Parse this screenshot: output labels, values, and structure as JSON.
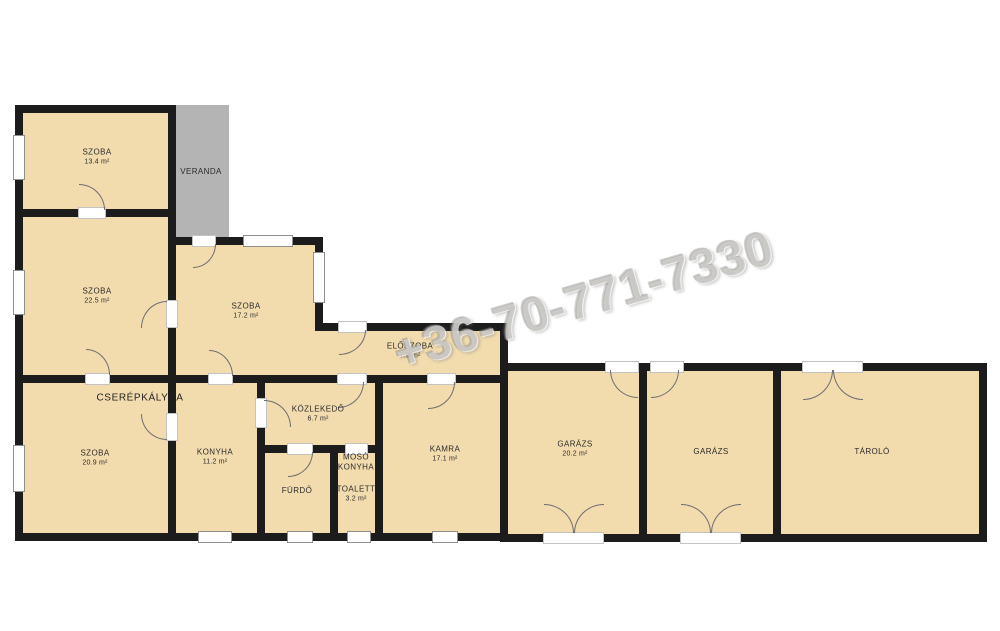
{
  "title": "Floor plan",
  "watermark": {
    "text": "+36-70-771-7330"
  },
  "fixtures": {
    "cserepkalyha_label": "CSERÉPKÁLYHA"
  },
  "colors": {
    "room_fill": "#f2dcae",
    "wall": "#1c1c1c",
    "veranda_fill": "#b4b4b4",
    "background": "#ffffff",
    "watermark_gray": "#b0ada8"
  },
  "rooms": [
    {
      "id": "szoba-13",
      "name": "SZOBA",
      "area": "13.4 m²"
    },
    {
      "id": "veranda",
      "name": "VERANDA",
      "area": ""
    },
    {
      "id": "szoba-22",
      "name": "SZOBA",
      "area": "22.5 m²"
    },
    {
      "id": "szoba-17",
      "name": "SZOBA",
      "area": "17.2 m²"
    },
    {
      "id": "eloszoba",
      "name": "ELŐSZOBA",
      "area": "7.9 m²"
    },
    {
      "id": "szoba-20",
      "name": "SZOBA",
      "area": "20.9 m²"
    },
    {
      "id": "konyha",
      "name": "KONYHA",
      "area": "11.2 m²"
    },
    {
      "id": "kozlekedo",
      "name": "KÖZLEKEDŐ",
      "area": "6.7 m²"
    },
    {
      "id": "furdo",
      "name": "FÜRDŐ",
      "area": ""
    },
    {
      "id": "moso-konyha",
      "name": "MOSÓ\nKONYHA",
      "area": ""
    },
    {
      "id": "toalett",
      "name": "TOALETT",
      "area": "3.2 m²"
    },
    {
      "id": "kamra",
      "name": "KAMRA",
      "area": "17.1 m²"
    },
    {
      "id": "garazs-1",
      "name": "GARÁZS",
      "area": "20.2 m²"
    },
    {
      "id": "garazs-2",
      "name": "GARÁZS",
      "area": ""
    },
    {
      "id": "tarolo",
      "name": "TÁROLÓ",
      "area": ""
    }
  ]
}
